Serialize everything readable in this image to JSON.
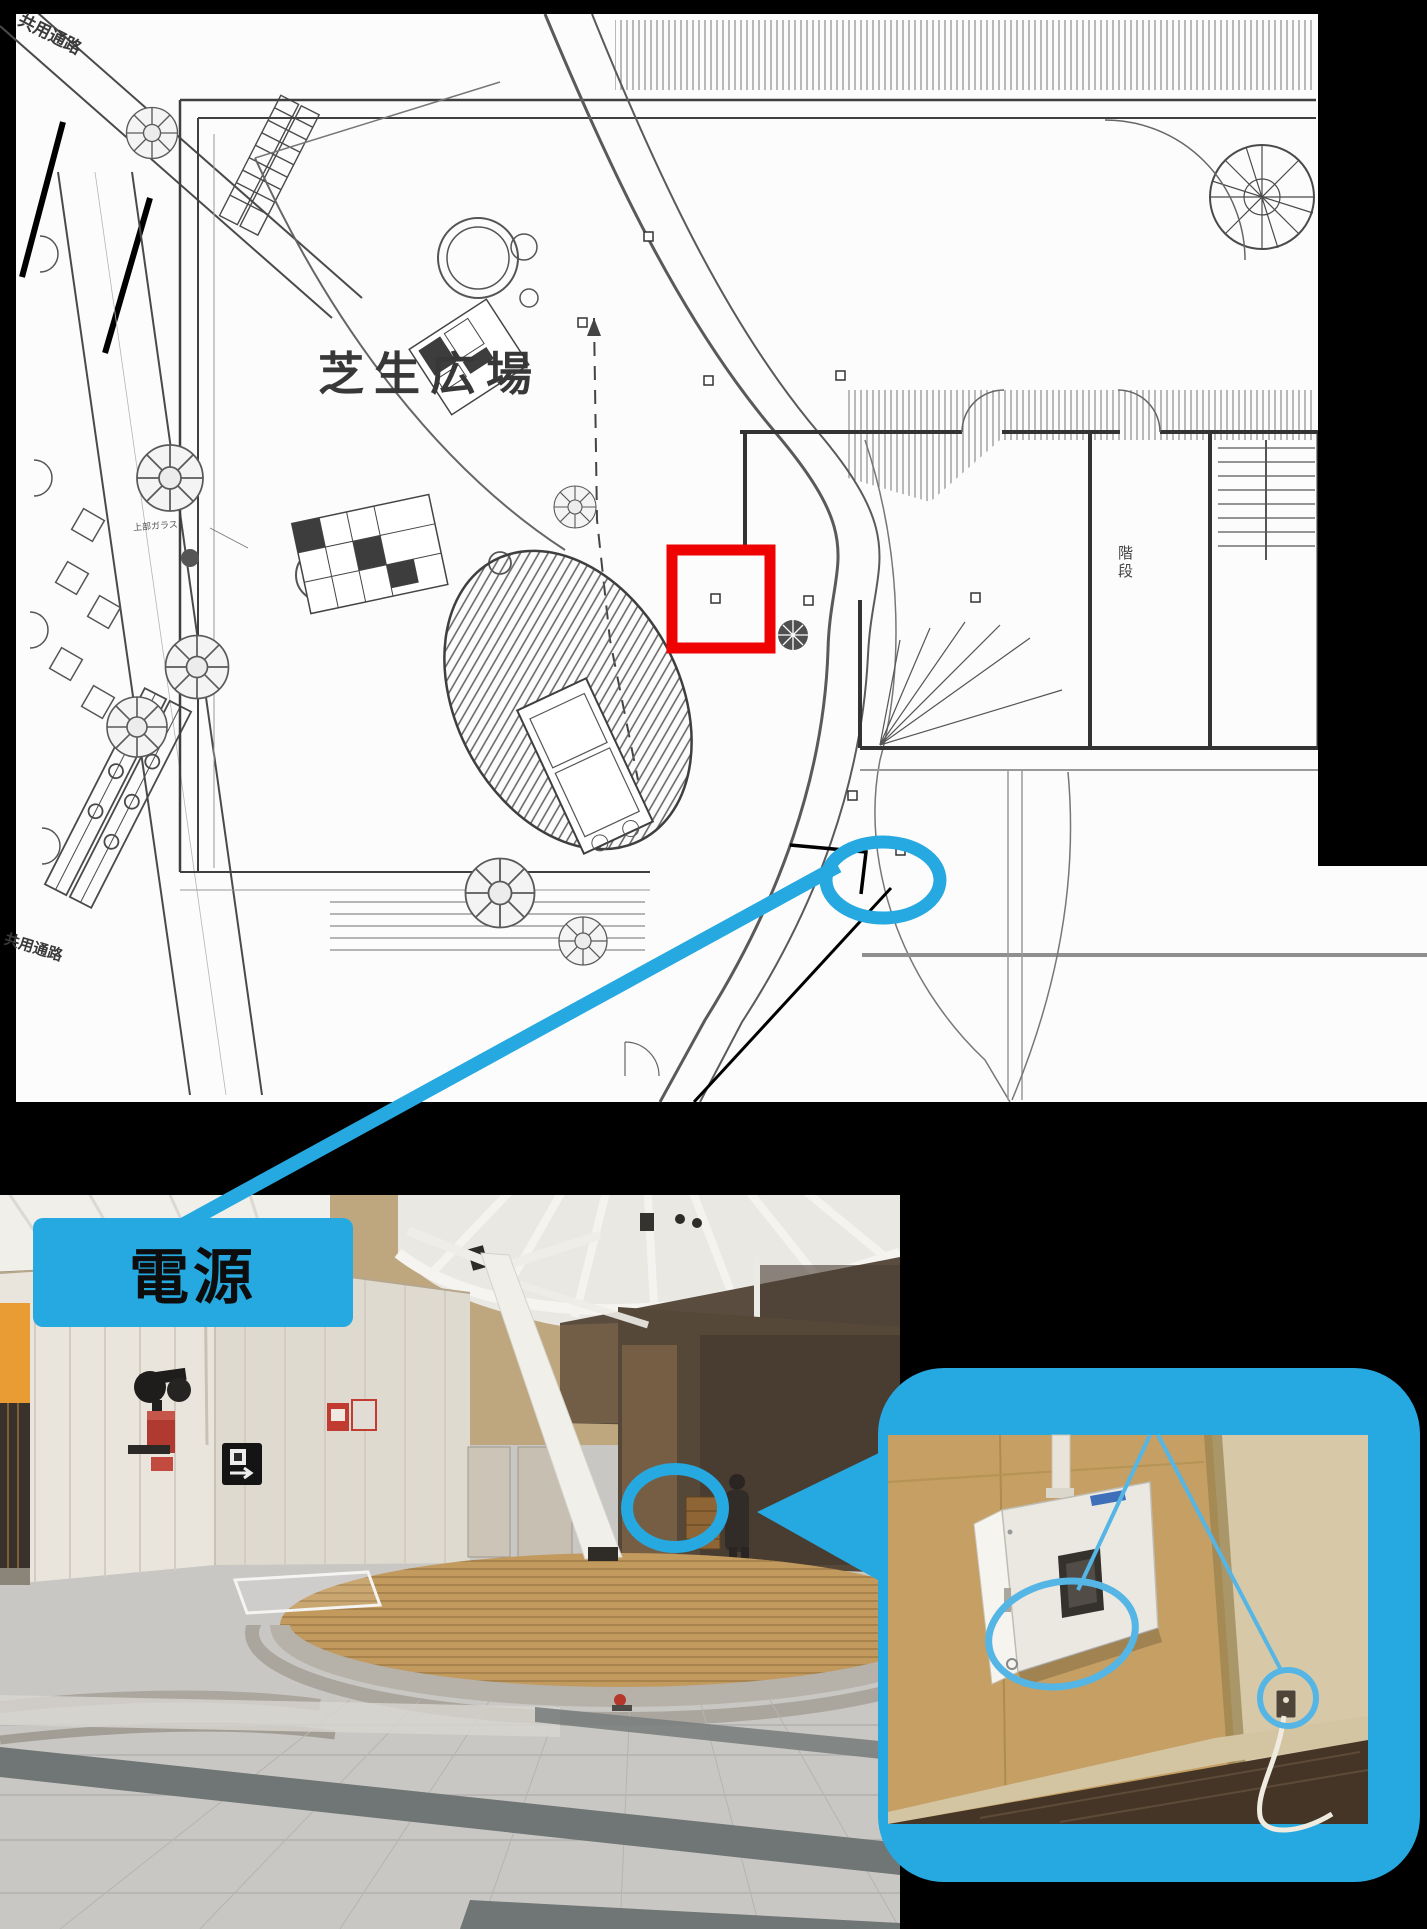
{
  "floor_plan": {
    "labels": {
      "corridor_top": "共用通路",
      "upper_glass": "上部ガラス",
      "lawn_plaza": "芝生広場",
      "stairs": "階段",
      "corridor_bottom": "共用通路"
    }
  },
  "photo": {
    "power_label": "電源"
  },
  "annotations": {
    "plan_target_marker": "red-square",
    "plan_source_marker": "blue-ellipse",
    "photo_marker": "blue-ellipse",
    "inset_subjects": [
      "distribution-board",
      "power-outlet"
    ]
  },
  "colors": {
    "accent_blue": "#25A9E0",
    "inset_annotation_blue": "#55B5E5",
    "marker_red": "#EE0202",
    "background_black": "#000000"
  }
}
